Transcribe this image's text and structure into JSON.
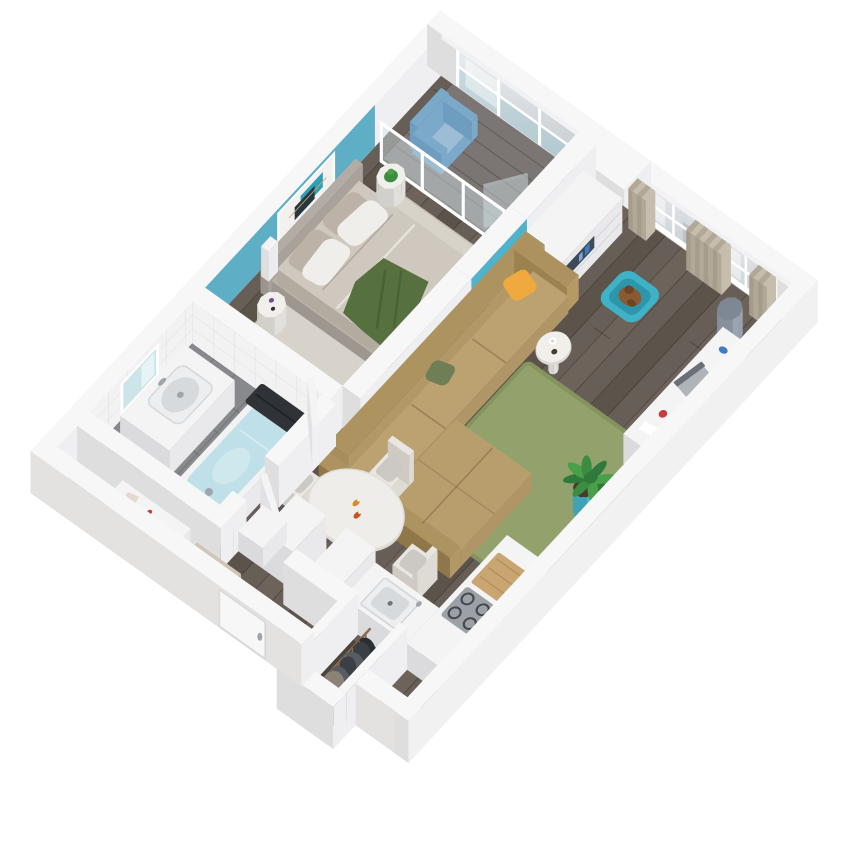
{
  "meta": {
    "title": "3D isometric cutaway floor plan render of a one-bedroom apartment",
    "view": "axonometric top-down cutaway, walls cut at uniform height",
    "background": "#FFFFFF"
  },
  "projection": {
    "origin": [
      440,
      52
    ],
    "axisX": [
      0.63,
      0.45
    ],
    "axisY": [
      -0.585,
      0.63
    ],
    "wallHeight": 42,
    "wallThickness": 22,
    "planSize": [
      600,
      700
    ]
  },
  "palette": {
    "bg": "#FFFFFF",
    "wallTop": "#F7F7F8",
    "wallLight": "#EFEFF1",
    "wallDark": "#DEDEDF",
    "wallOuterSE": "#F1F1F2",
    "wallOuterSW": "#E3E2E1",
    "blueWall": "#5EAEC6",
    "tealLight": "#4FB3CB",
    "tealDark": "#3E99B0",
    "floorBase": "#675E57",
    "floorDark": "#50483F",
    "floorLight": "#7A6E63",
    "floorLine": "rgba(30,24,20,0.38)",
    "balconyFloor": "#7B7573",
    "balconyLine": "rgba(40,36,34,0.35)",
    "bathFloor": "#87898C",
    "bathGrid": "rgba(50,52,55,0.22)",
    "closetFloor": "#4A443F",
    "rugBedroom": "#D8D3CA",
    "rugGreen": "#93A26C",
    "rugGreenEdge": "#85945F",
    "bedPlatform": "#B7B1A9",
    "mattress": "#CFC8BE",
    "headboard": "#B3ACA5",
    "pillowWhite": "#F0EEEB",
    "pillowTaupe": "#BCB2A7",
    "throwGreen": "#57703F",
    "throwDark": "#496133",
    "sofaBase": "#B29767",
    "sofaSeat": "#BCA271",
    "sofaBack": "#A78D5C",
    "pillowOrange": "#EFA93F",
    "pillowOlive": "#6F7E55",
    "white": "#F4F4F5",
    "whiteSide": "#E9E9EC",
    "whiteDark": "#DBDBDE",
    "dresserNiche": "#3E4A5A",
    "accentBlue": "#3E7EC0",
    "curtainA": "#C7BDAD",
    "curtainB": "#B2A898",
    "glassLight": "#EBEEF0",
    "glassDark": "#C3C9CE",
    "glassTeal": "#8FC0CC",
    "frame": "#FFFFFF",
    "tableTop": "#EFEDEA",
    "tableEdge": "#DCD9D4",
    "chairBody": "#E9E6E1",
    "chairCushion": "#CCC9C4",
    "legBrown": "#6B5B4C",
    "cooktop": "#9BA1A7",
    "cooktopRing": "#43484E",
    "sinkInner": "#D7DADC",
    "wood": "#C9A571",
    "woodLine": "#B28F5B",
    "tubWater": "#BFE0E8",
    "towel": "#2F3338",
    "chrome": "#9FA6AB",
    "mirror": "#CDE4E8",
    "petBed": "#3FB2C7",
    "petBedInner": "#2E96AB",
    "pet": "#8A5A33",
    "petDark": "#6E4426",
    "leaf1": "#2F7A3B",
    "leaf2": "#49A04B",
    "leaf3": "#3C8C42",
    "pot": "#54B9C9",
    "potDark": "#3FA3B4",
    "soil": "#4A3A2C",
    "basket": "#9AA4B0",
    "basketDark": "#87919D",
    "basketTop": "#7E8894",
    "chairBlue": "#7BA9C9",
    "chairBlueDark": "#6E9DBF",
    "chairBlueSeat": "#9DBDD6",
    "clothes1": "#3A3E45",
    "clothes2": "#575C64",
    "clothes3": "#2B2E33",
    "clothes4": "#8A8177",
    "rail": "#8A6B4C",
    "red": "#C63B3B",
    "redDark": "#8A2F2F",
    "amber": "#D98A2B",
    "rust": "#C4561F",
    "artCanvas": "#F2F1EF",
    "artDark": "#273640",
    "artTeal": "#2FA0B4",
    "artGold": "#C9A96A",
    "benchBeige": "#C6BCAB",
    "benchTop": "#CFC6B6",
    "shadow": "rgba(40,40,45,0.10)"
  },
  "rooms": [
    {
      "id": "bedroom",
      "features": [
        "blue accent wall",
        "abstract artwork",
        "double bed with green throw",
        "two round nightstands",
        "light rug"
      ]
    },
    {
      "id": "balcony",
      "features": [
        "glazed window wall",
        "glass partition",
        "blue armchair",
        "grey plank floor"
      ]
    },
    {
      "id": "living-room",
      "features": [
        "two curtained windows",
        "white drawer sideboard",
        "tan corner sofa",
        "green rug",
        "pet bed",
        "desk with laptop",
        "potted plant",
        "storage basket",
        "round side table"
      ]
    },
    {
      "id": "dining-area",
      "features": [
        "oval white table",
        "four upholstered chairs",
        "two bottles on table"
      ]
    },
    {
      "id": "kitchen",
      "features": [
        "L-shaped white counter",
        "sink",
        "grey cooktop",
        "wooden board",
        "tall cabinet"
      ]
    },
    {
      "id": "bathroom",
      "features": [
        "bathtub with water",
        "dark towel",
        "vanity with basin",
        "lit mirror",
        "tiled wall",
        "grey tile floor",
        "black bin"
      ]
    },
    {
      "id": "hallway-entry",
      "features": [
        "entry door in wall",
        "white console with red objects",
        "beige bench",
        "white cabinets",
        "open doors"
      ]
    },
    {
      "id": "wardrobe",
      "features": [
        "open closet",
        "wooden rail",
        "hanging dark clothes"
      ]
    }
  ],
  "furniture_names": [
    "bed",
    "headboard",
    "nightstand-1",
    "nightstand-2",
    "artwork",
    "mirror",
    "balcony-armchair",
    "dresser",
    "pet-bed",
    "sofa",
    "side-table",
    "green-rug",
    "potted-plant",
    "desk",
    "laptop",
    "storage-basket",
    "dining-table",
    "dining-chair-left",
    "dining-chair-top",
    "dining-chair-right",
    "dining-chair-bottom",
    "kitchen-counter",
    "fridge-cabinet",
    "bathtub",
    "vanity-sink",
    "entry-console",
    "entry-bench",
    "hall-cabinet",
    "clothes-rail",
    "hanging-clothes",
    "bedroom-door",
    "bathroom-door",
    "entry-door",
    "window-curtains"
  ]
}
